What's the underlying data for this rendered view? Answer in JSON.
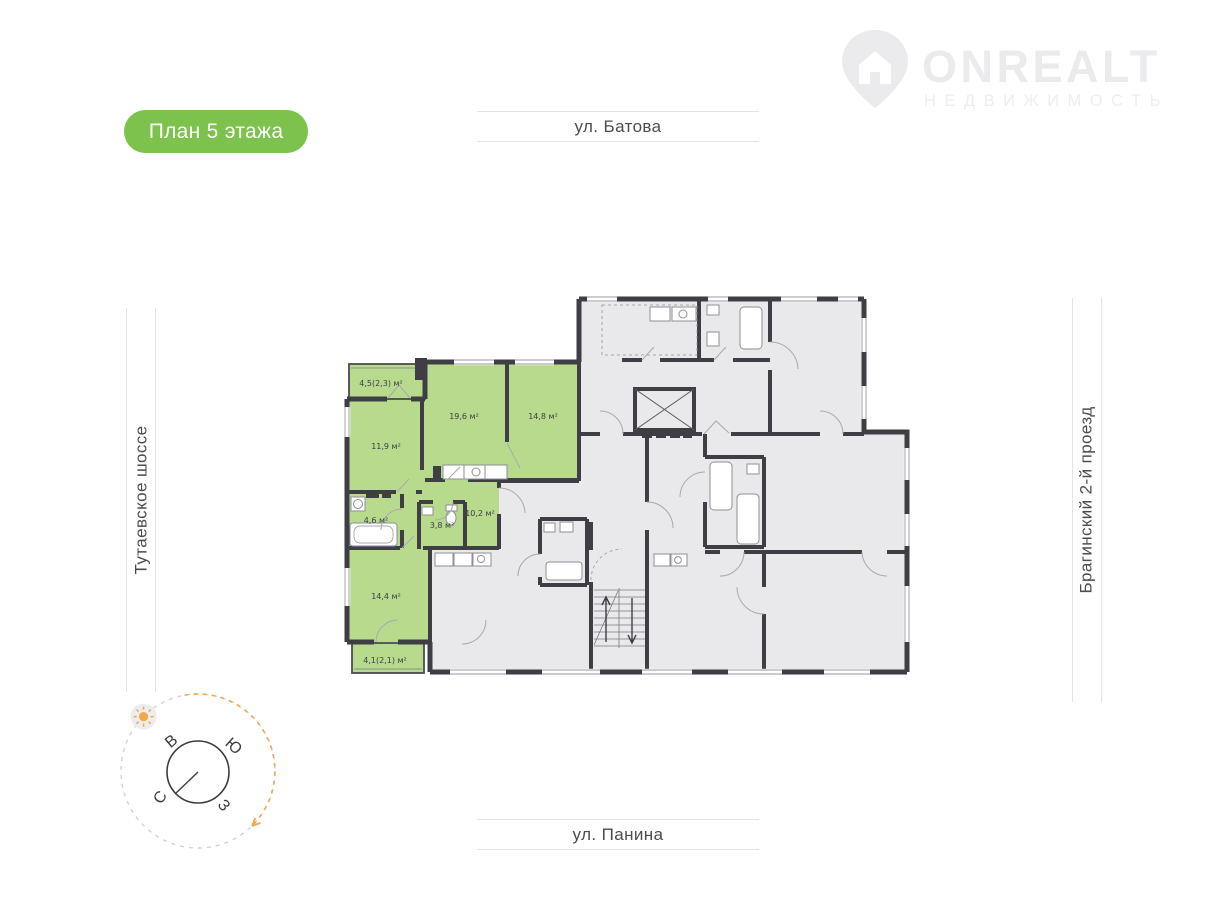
{
  "logo": {
    "brand": "ONREALT",
    "subtitle": "НЕДВИЖИМОСТЬ",
    "color": "#ebebed"
  },
  "badge": {
    "label": "План 5 этажа",
    "background": "#7cc24d",
    "text_color": "#ffffff"
  },
  "streets": {
    "top": "ул. Батова",
    "bottom": "ул. Панина",
    "left": "Тутаевское шоссе",
    "right": "Брагинский 2-й проезд"
  },
  "compass": {
    "letter_top": "В",
    "letter_right": "Ю",
    "letter_left": "С",
    "letter_bottom": "З",
    "accent_orange": "#f2a64e",
    "dash_gray": "#d2d2d4"
  },
  "plan": {
    "wall_color": "#3e3e44",
    "room_fill": "#e9e9ec",
    "highlight_fill": "#b7da8d",
    "rooms": [
      {
        "label": "4,5(2,3) м²"
      },
      {
        "label": "19,6 м²"
      },
      {
        "label": "14,8 м²"
      },
      {
        "label": "11,9 м²"
      },
      {
        "label": "4,6 м²"
      },
      {
        "label": "3,8 м²"
      },
      {
        "label": "10,2 м²"
      },
      {
        "label": "14,4 м²"
      },
      {
        "label": "4,1(2,1) м²"
      }
    ]
  }
}
